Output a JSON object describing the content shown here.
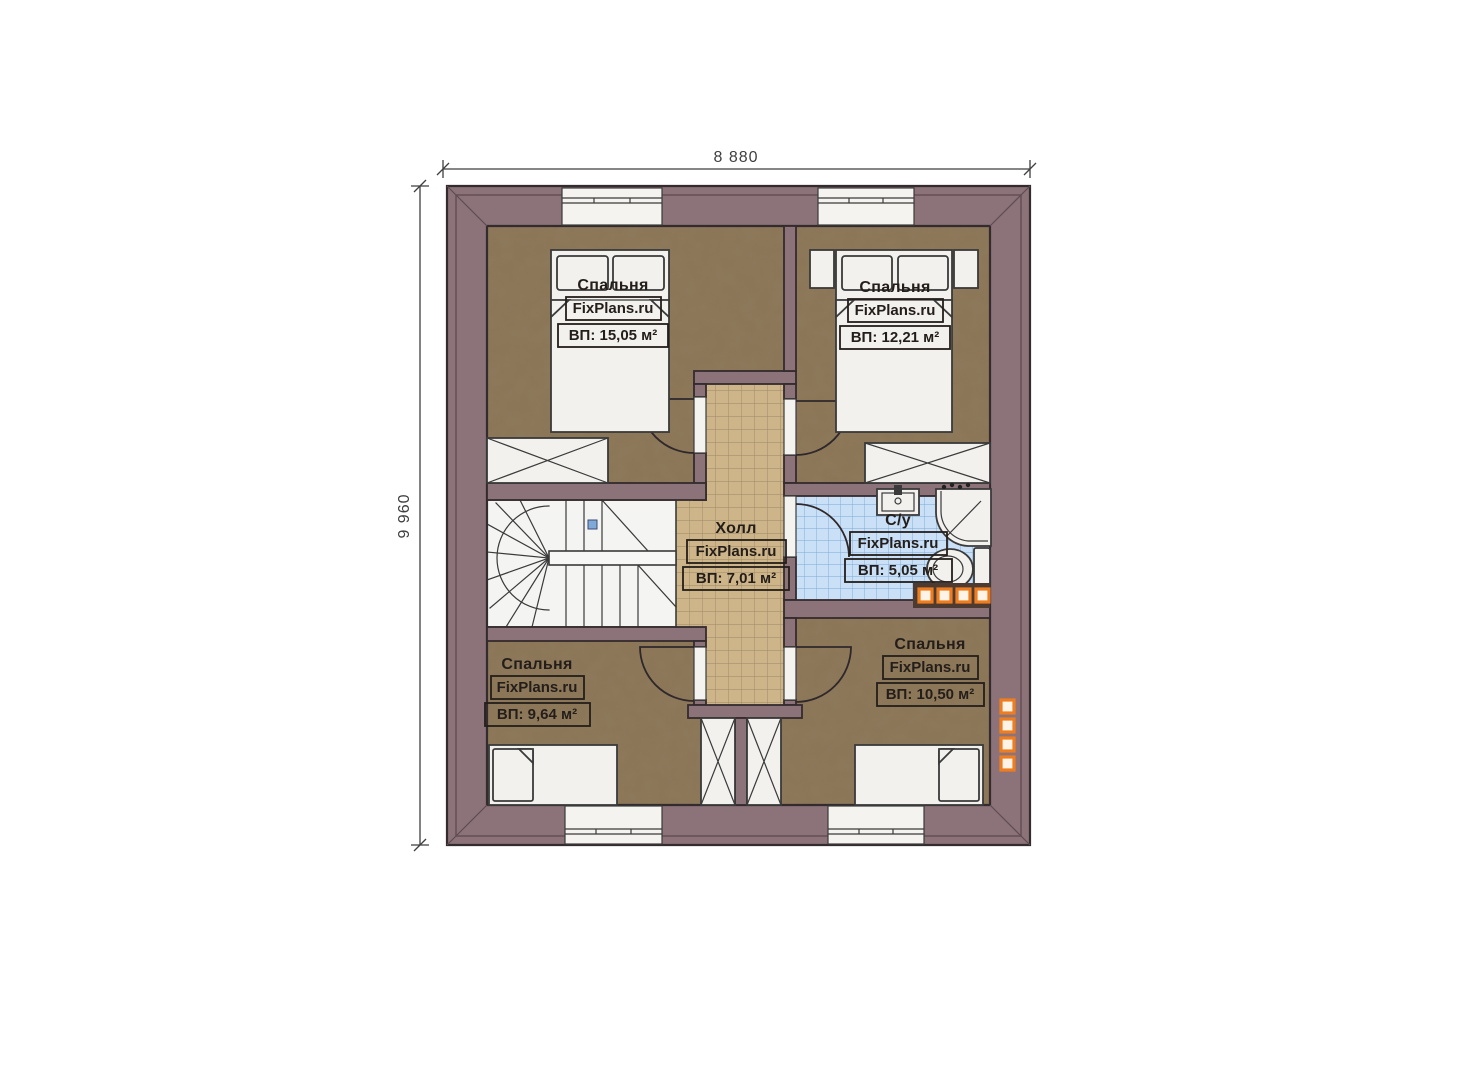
{
  "page": {
    "background": "#ffffff",
    "type": "floor-plan"
  },
  "dimensions": {
    "width_label": "8 880",
    "height_label": "9 960"
  },
  "rooms": [
    {
      "id": "bedroom-top-left",
      "name": "Спальня",
      "watermark": "FixPlans.ru",
      "area": "ВП: 15,05 м²"
    },
    {
      "id": "bedroom-top-right",
      "name": "Спальня",
      "watermark": "FixPlans.ru",
      "area": "ВП: 12,21 м²"
    },
    {
      "id": "hall",
      "name": "Холл",
      "watermark": "FixPlans.ru",
      "area": "ВП: 7,01 м²"
    },
    {
      "id": "bathroom",
      "name": "С/у",
      "watermark": "FixPlans.ru",
      "area": "ВП: 5,05 м²"
    },
    {
      "id": "bedroom-bottom-left",
      "name": "Спальня",
      "watermark": "FixPlans.ru",
      "area": "ВП: 9,64 м²"
    },
    {
      "id": "bedroom-bottom-right",
      "name": "Спальня",
      "watermark": "FixPlans.ru",
      "area": "ВП: 10,50 м²"
    }
  ],
  "colors": {
    "wall": "#8c7279",
    "outline": "#332b2e",
    "bedroom_floor": "#8b7557",
    "hall_tile": "#cdb489",
    "bathroom_tile": "#c9e0f7",
    "furniture": "#f2f1ee",
    "radiator_orange": "#ee7d20",
    "stair_node_blue": "#8193c5"
  }
}
